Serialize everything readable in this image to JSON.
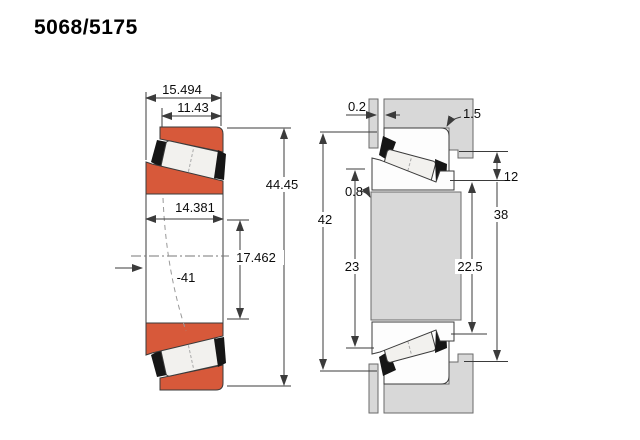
{
  "title": "5068/5175",
  "colors": {
    "part_orange": "#d7593a",
    "steel_gray": "#d8d8d8",
    "roller_white": "#f2f1ee",
    "cage_black": "#161616",
    "line_dark": "#3b3b3b"
  },
  "left_view": {
    "dims": {
      "overall_width": "15.494",
      "cone_front_width": "11.43",
      "outer_diameter": "44.45",
      "cup_inner_width": "14.381",
      "race_depth": "17.462",
      "offset_note": "-41"
    }
  },
  "right_view": {
    "dims": {
      "side_clearance": "0.2",
      "housing_fillet_radius": "1.5",
      "shaft_fillet_radius": "0.8",
      "housing_shoulder": "42",
      "shaft_shoulder": "23",
      "cup_front_standout": "12",
      "housing_bore_depth": "38",
      "cone_front_standout": "22.5"
    }
  }
}
